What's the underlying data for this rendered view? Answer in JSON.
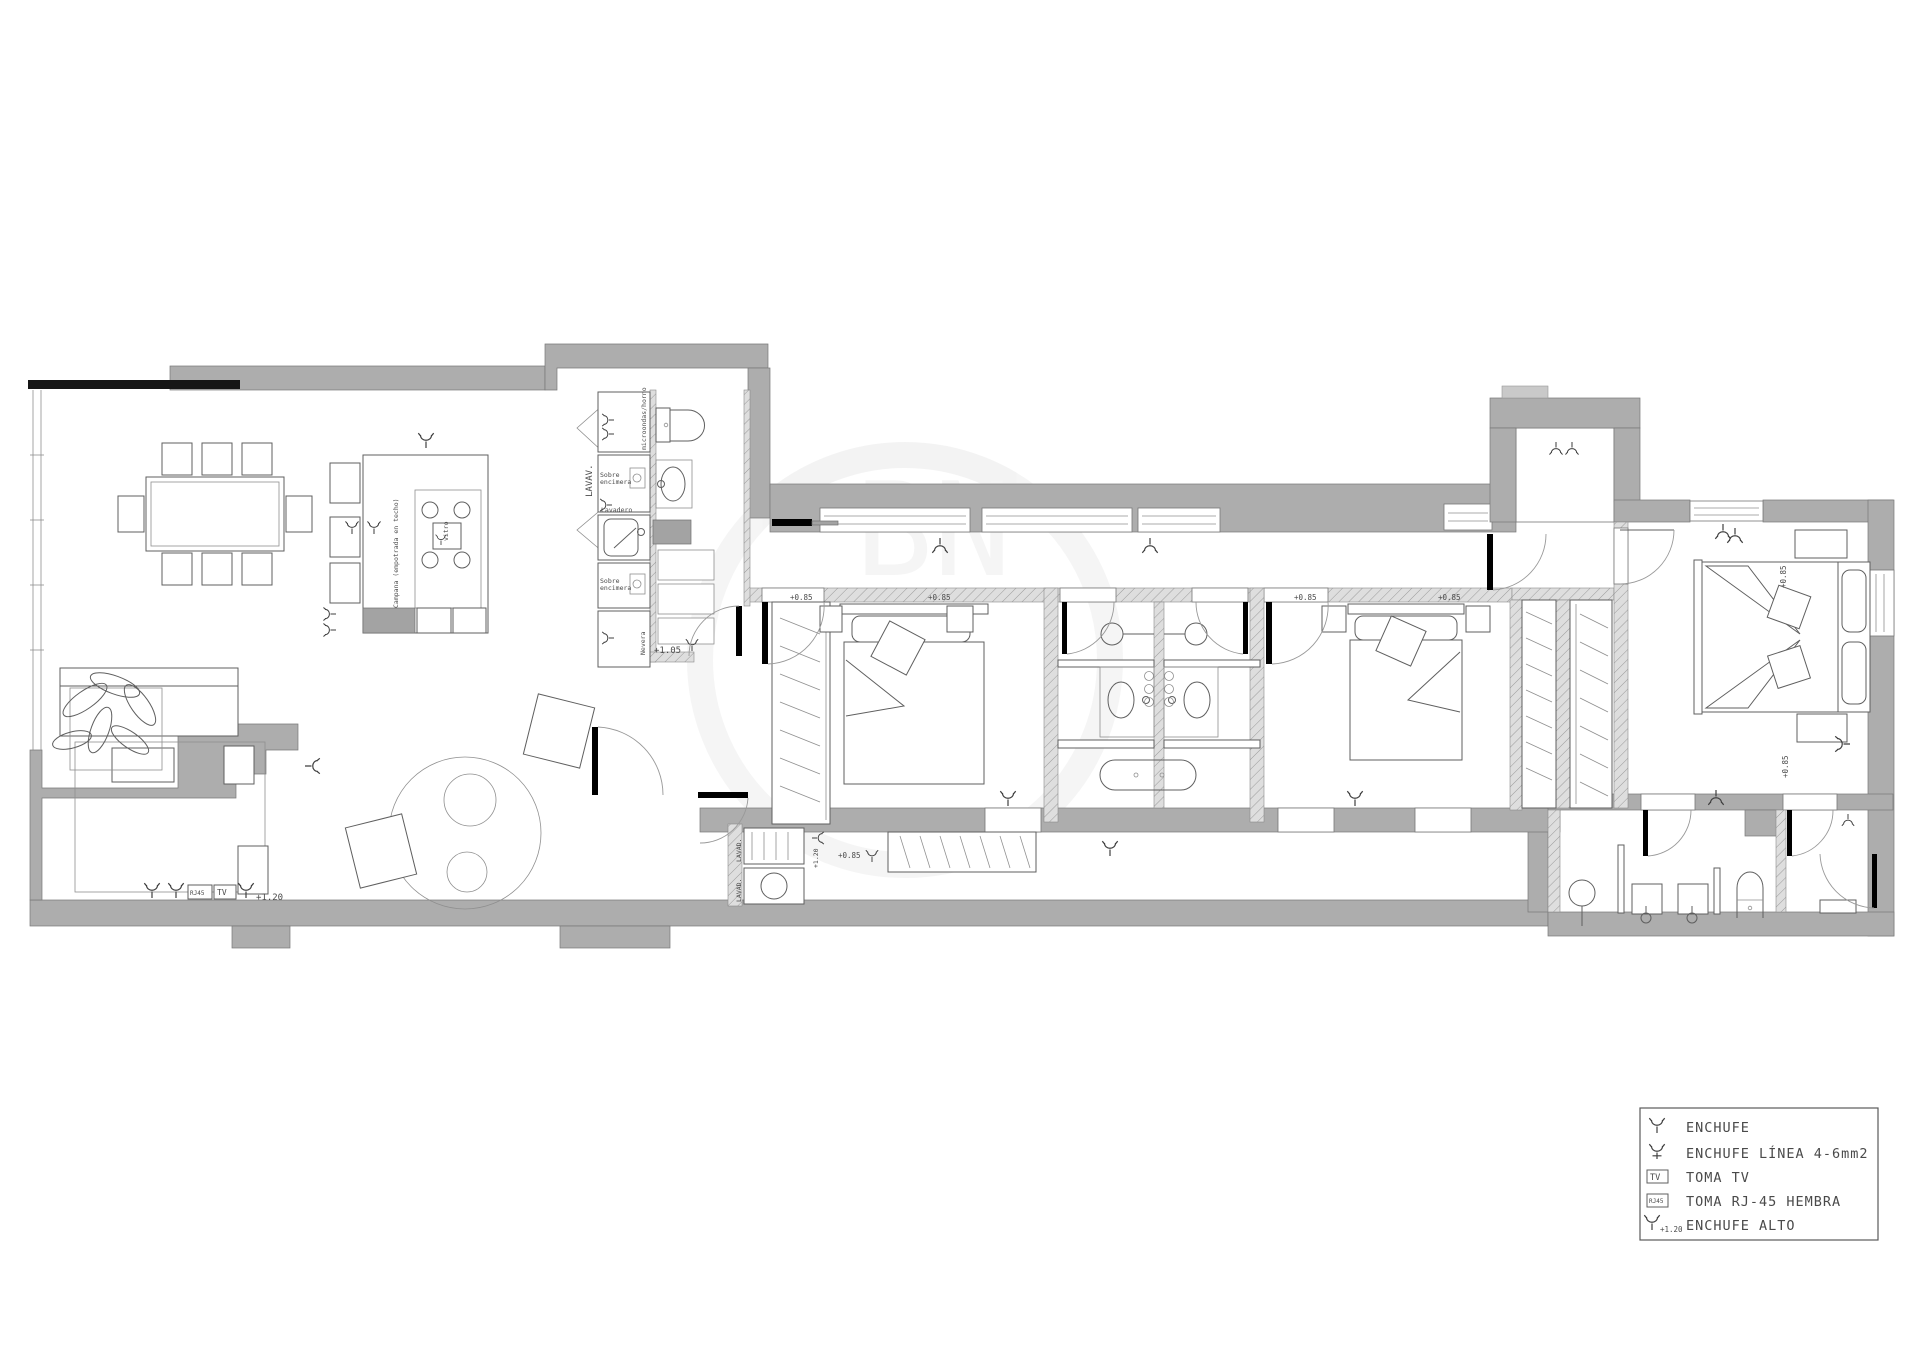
{
  "colors": {
    "wall": "#adadad",
    "wall_light": "#c9c9c9",
    "black_band": "#161616",
    "line": "#5f5f5f",
    "background": "#ffffff",
    "legend_border": "#5a5a5a"
  },
  "legend": {
    "items": [
      {
        "symbol": "enchufe-icon",
        "label": "ENCHUFE"
      },
      {
        "symbol": "enchufe-linea-icon",
        "label": "ENCHUFE LÍNEA 4-6mm2"
      },
      {
        "symbol": "toma-tv-icon",
        "symbol_text": "TV",
        "label": "TOMA TV"
      },
      {
        "symbol": "toma-rj45-icon",
        "symbol_text": "RJ45",
        "label": "TOMA RJ-45 HEMBRA"
      },
      {
        "symbol": "enchufe-alto-icon",
        "sub": "+1.20",
        "label": "ENCHUFE ALTO"
      }
    ]
  },
  "labels": {
    "lavav": "LAVAV.",
    "microondas": "microondas/horno",
    "sobre1": "Sobre",
    "sobre2": "encimera",
    "lavadero": "Lavadero",
    "nevera": "Nevera",
    "campana": "Campana (empotrada en techo)",
    "vitro": "vitro",
    "lavad": "LAVAD.",
    "h085": "+0.85",
    "h105": "+1.05",
    "h120": "+1.20",
    "tv": "TV",
    "rj45": "RJ45",
    "watermark": "BN"
  }
}
